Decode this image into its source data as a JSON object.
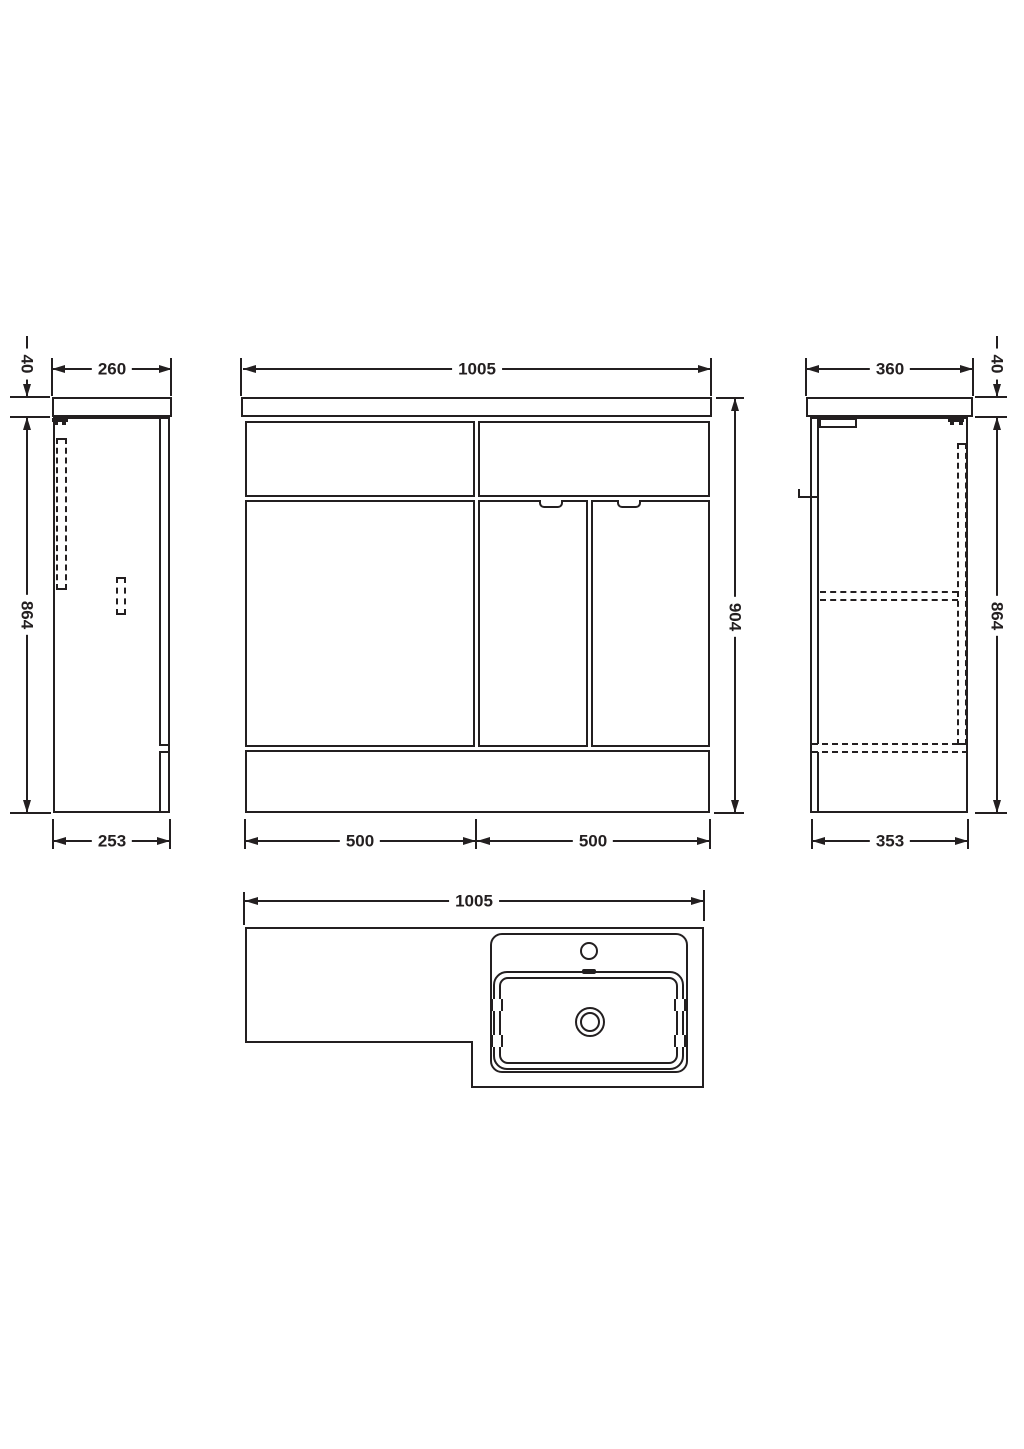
{
  "document": {
    "background": "#ffffff",
    "line_color": "#231f20"
  },
  "views": {
    "side_left": {
      "dims": {
        "top_width": "260",
        "top_thickness": "40",
        "height": "864",
        "bottom_width": "253"
      }
    },
    "front": {
      "dims": {
        "top_width": "1005",
        "height": "904",
        "bottom_left_width": "500",
        "bottom_right_width": "500"
      }
    },
    "side_right": {
      "dims": {
        "top_width": "360",
        "top_thickness": "40",
        "height": "864",
        "bottom_width": "353"
      }
    },
    "plan": {
      "dims": {
        "top_width": "1005"
      }
    }
  }
}
